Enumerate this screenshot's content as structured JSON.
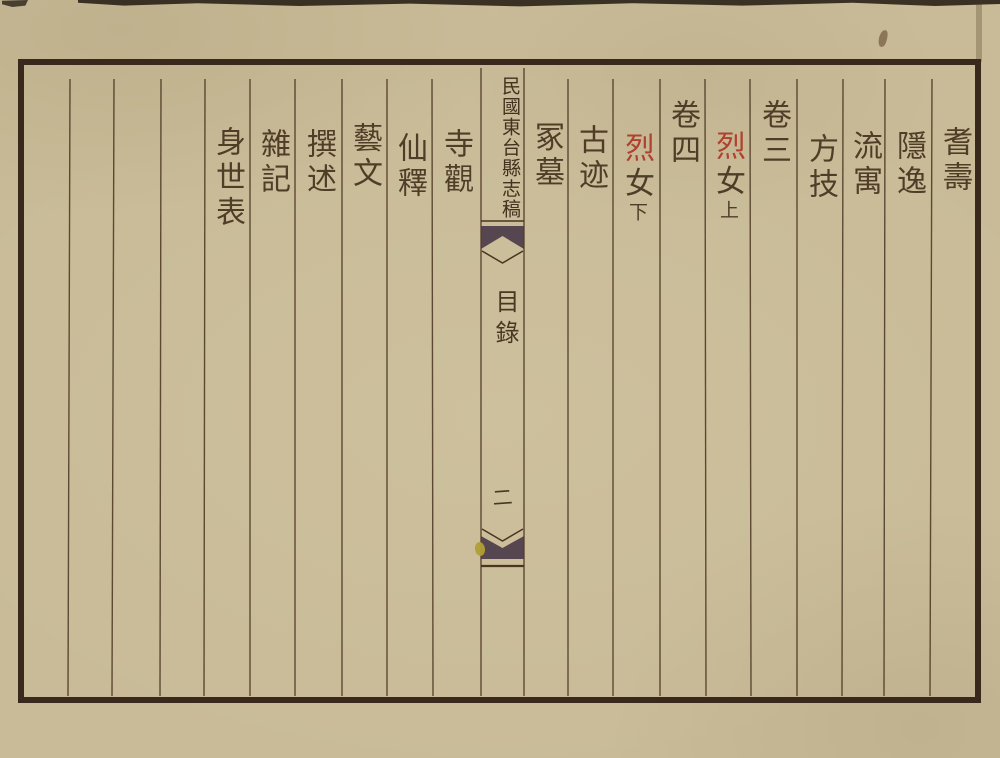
{
  "center_column": {
    "title": "民國東台縣志稿",
    "section": "目錄",
    "page_number": "二"
  },
  "right_half_columns": [
    {
      "main": "耆壽"
    },
    {
      "main": "隱逸"
    },
    {
      "main": "流寓"
    },
    {
      "main": "方技"
    },
    {
      "main": "卷三"
    },
    {
      "red": "烈",
      "main": "女",
      "suffix": "上"
    },
    {
      "main": "卷四"
    },
    {
      "red": "烈",
      "main": "女",
      "suffix": "下"
    },
    {
      "main": "古迹"
    },
    {
      "main": "冢墓"
    }
  ],
  "left_half_columns": [
    {
      "main": "寺觀"
    },
    {
      "main": "仙釋"
    },
    {
      "main": "藝文"
    },
    {
      "main": "撰述"
    },
    {
      "main": "雜記"
    },
    {
      "main": "身世表"
    }
  ],
  "colors": {
    "paper": "#c9bb97",
    "ink": "#493723",
    "red_ink": "#ae3b2a",
    "frame": "#38291c",
    "fishtail": "#4c3c49",
    "ink_drop_yellow": "#b09f35"
  }
}
